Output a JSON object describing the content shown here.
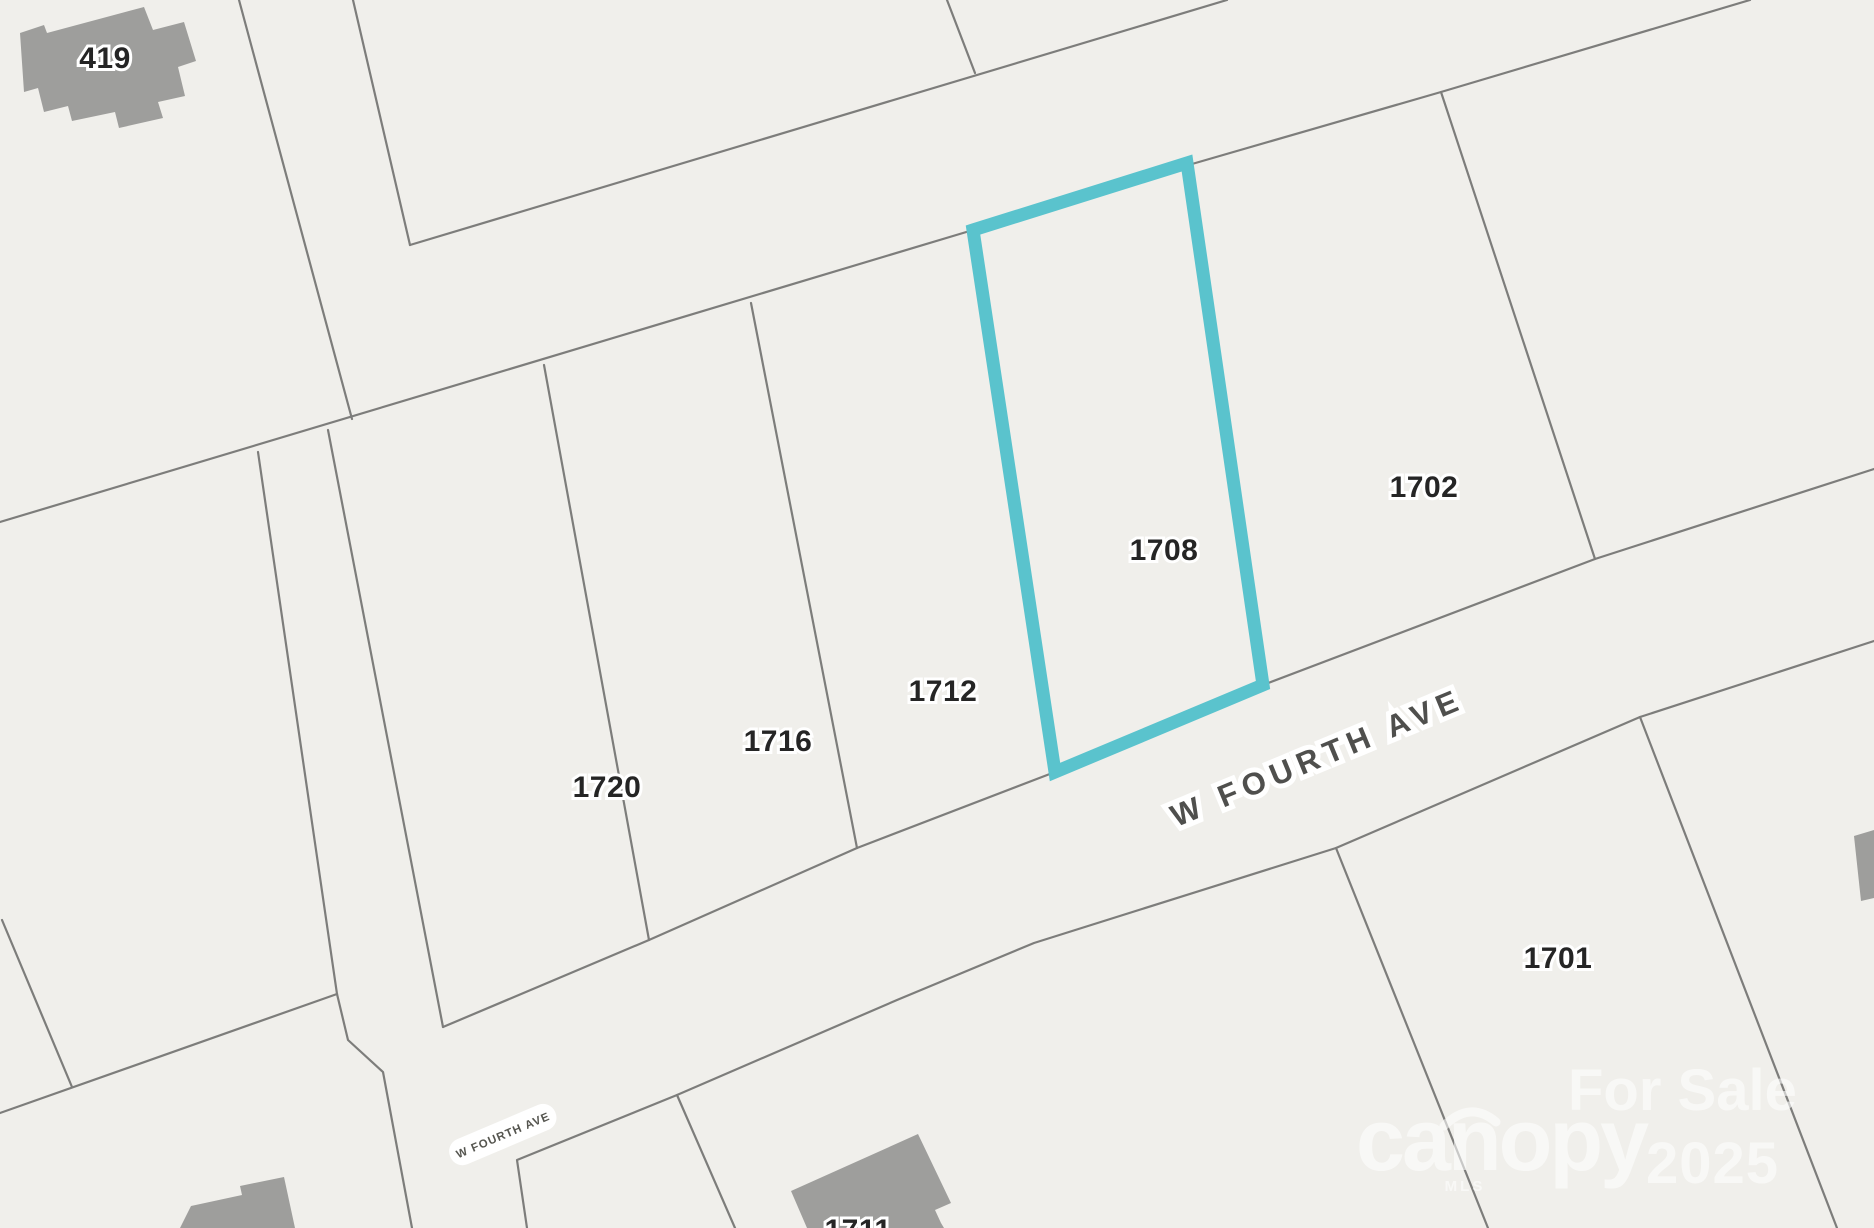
{
  "map_labels": {
    "building_419": "419",
    "parcel_1720": "1720",
    "parcel_1716": "1716",
    "parcel_1712": "1712",
    "parcel_1708": "1708",
    "parcel_1702": "1702",
    "parcel_1701": "1701",
    "building_1711": "1711"
  },
  "streets": {
    "main_label": "W FOURTH AVE",
    "badge_label": "W FOURTH AVE"
  },
  "selected_parcel": {
    "label": "1708",
    "outline_color": "#5ac3cd"
  },
  "watermark": {
    "for_sale": "For Sale",
    "brand": "canopy",
    "brand_sub": "MLS",
    "year": "2025"
  },
  "colors": {
    "background": "#f0efeb",
    "parcel_line": "#7d7d7b",
    "building_fill": "#9e9e9c",
    "parcel_label_text": "#252525",
    "street_label_text": "#4f4f4d",
    "highlight_teal": "#5ac3cd",
    "watermark_white": "#ffffff"
  }
}
